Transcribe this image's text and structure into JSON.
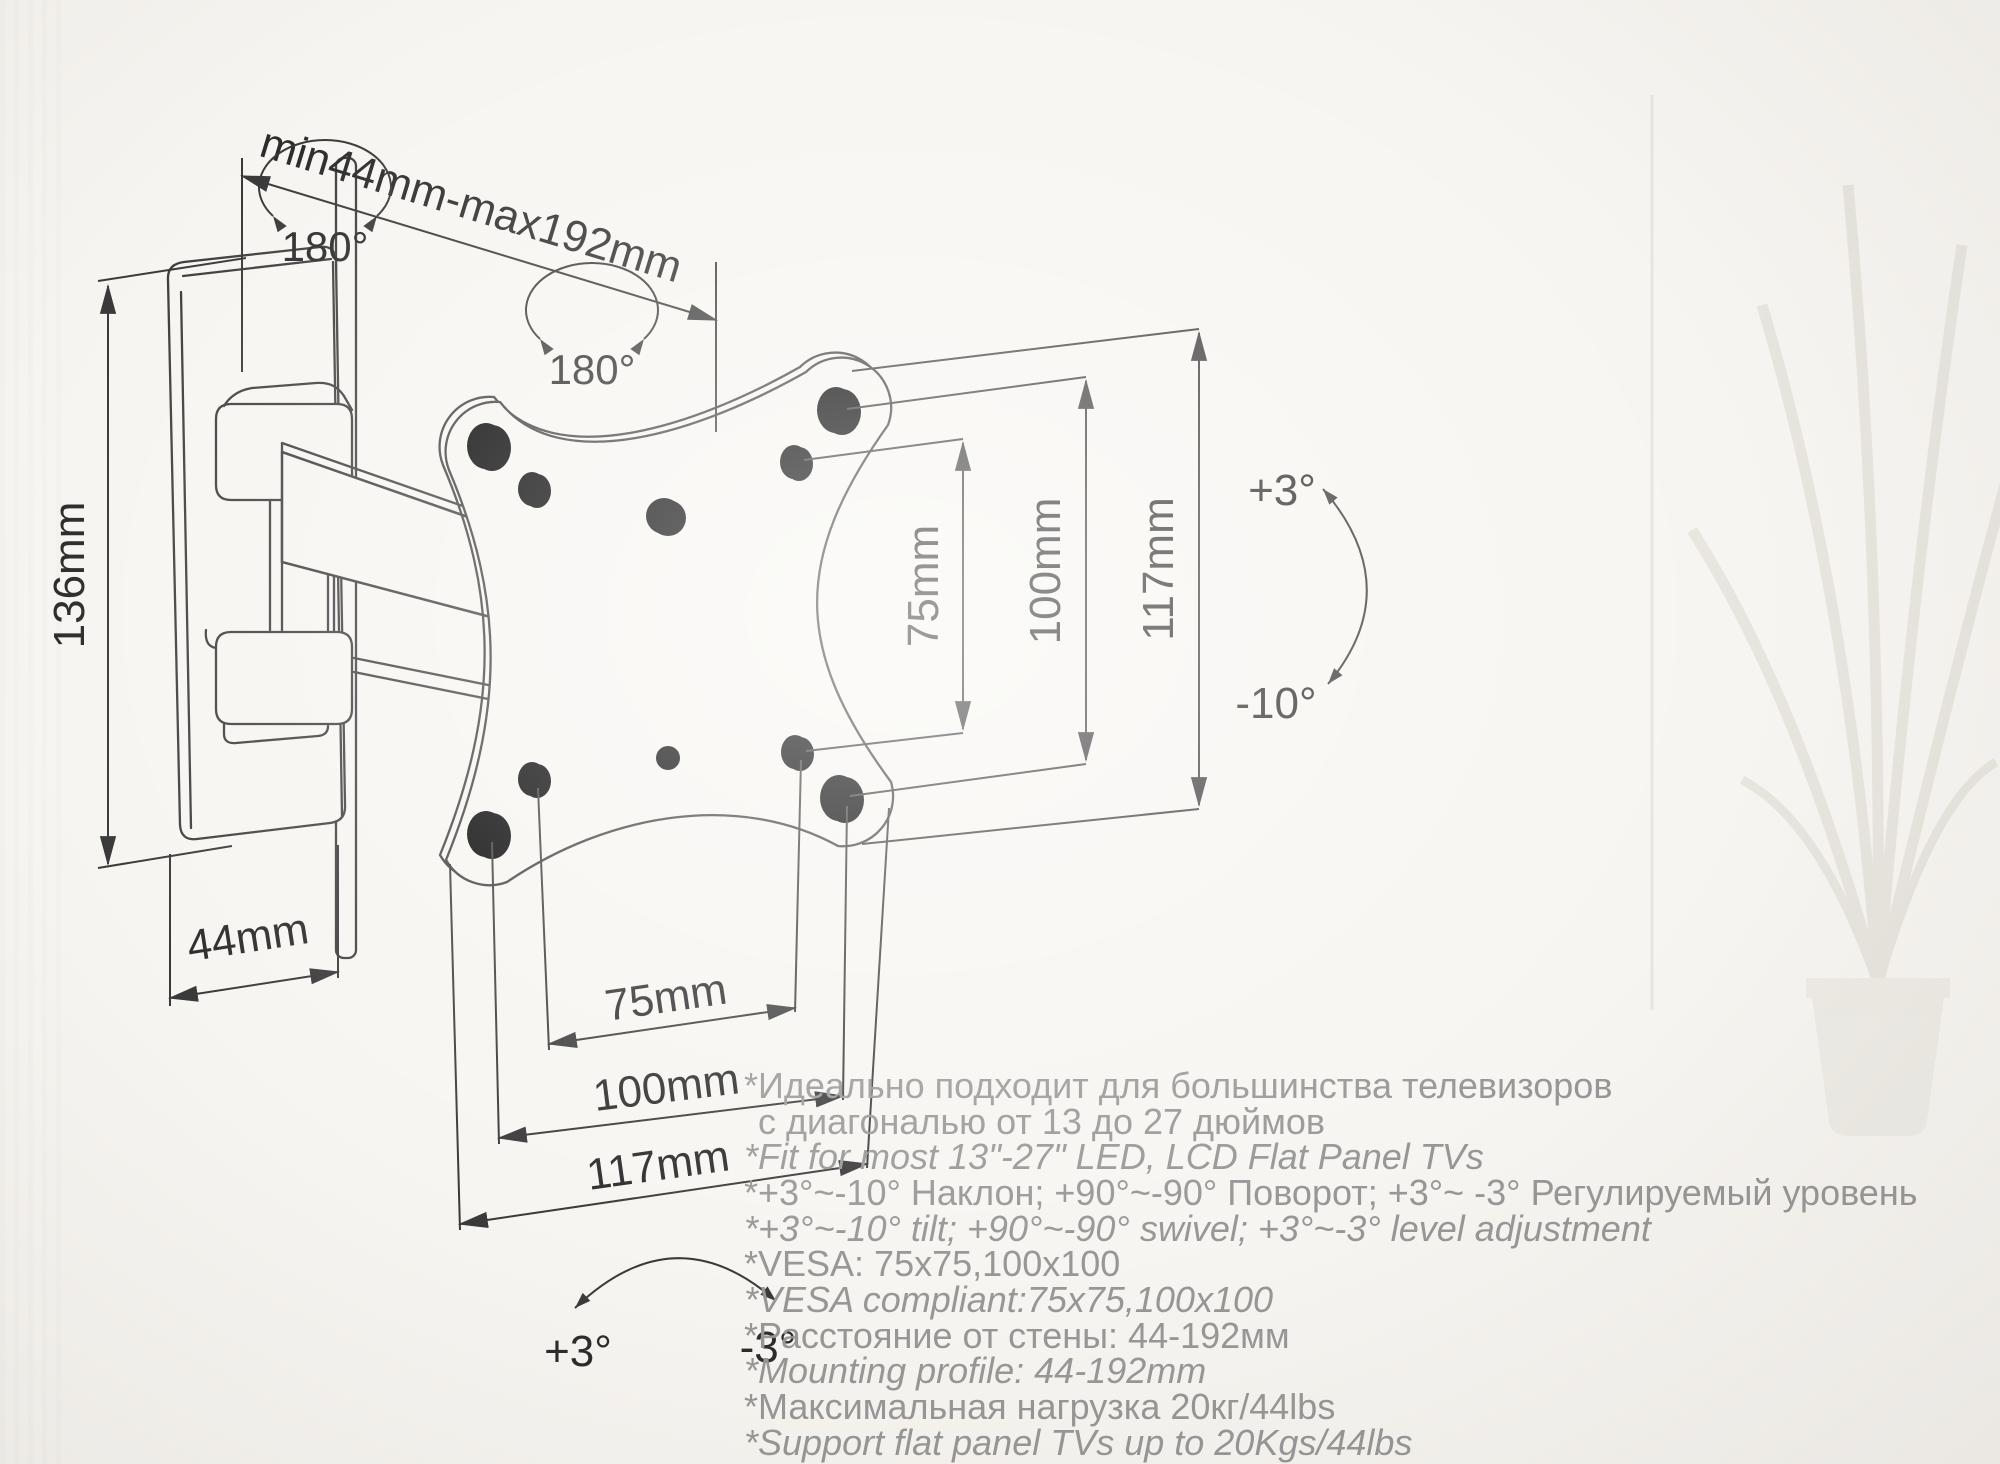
{
  "colors": {
    "background": "#f7f5f1",
    "drawing_line": "#3f3f3f",
    "dimension_text": "#2c2c2c",
    "spec_text": "#979797"
  },
  "drawing": {
    "swivel_wall_label": "180°",
    "swivel_vesa_label": "180°",
    "wall_offset_label": "min44mm-max192mm",
    "plate_height_label": "136mm",
    "plate_depth_label": "44mm",
    "vesa_vertical_inner": "75mm",
    "vesa_vertical_outer": "100mm",
    "vesa_vertical_plate": "117mm",
    "vesa_horizontal_inner": "75mm",
    "vesa_horizontal_outer": "100mm",
    "vesa_horizontal_plate": "117mm",
    "tilt_up_label": "+3°",
    "tilt_down_label": "-10°",
    "level_left_label": "+3°",
    "level_right_label": "-3°"
  },
  "specs": [
    {
      "text": "*Идеально подходит для большинства телевизоров",
      "lang": "ru"
    },
    {
      "text": " с диагональю от 13 до 27 дюймов",
      "lang": "ru"
    },
    {
      "text": "*Fit for most 13\"-27\" LED, LCD Flat Panel TVs",
      "lang": "en"
    },
    {
      "text": "*+3°~-10° Наклон; +90°~-90° Поворот; +3°~ -3° Регулируемый уровень",
      "lang": "ru"
    },
    {
      "text": "*+3°~-10° tilt; +90°~-90° swivel; +3°~-3° level adjustment",
      "lang": "en"
    },
    {
      "text": "*VESA: 75x75,100x100",
      "lang": "ru"
    },
    {
      "text": "*VESA compliant:75x75,100x100",
      "lang": "en"
    },
    {
      "text": "*Расстояние от стены: 44-192мм",
      "lang": "ru"
    },
    {
      "text": "*Mounting profile: 44-192mm",
      "lang": "en"
    },
    {
      "text": "*Максимальная нагрузка 20кг/44lbs",
      "lang": "ru"
    },
    {
      "text": "*Support flat panel TVs up to 20Kgs/44lbs",
      "lang": "en"
    }
  ]
}
